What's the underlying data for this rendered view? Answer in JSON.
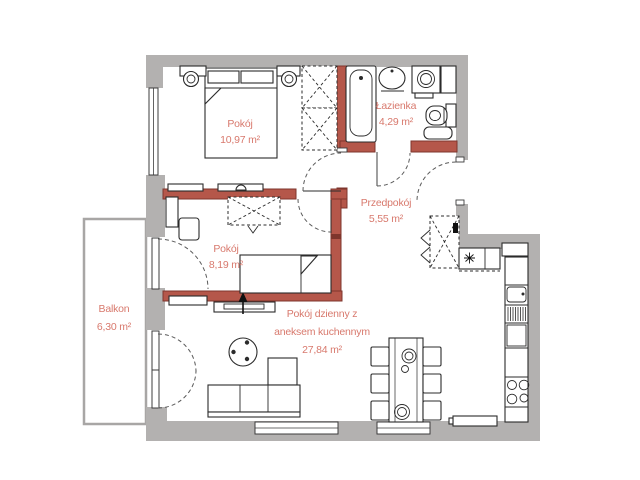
{
  "rooms": {
    "bedroom_1": {
      "name": "Pokój",
      "area": "10,97 m²"
    },
    "bathroom": {
      "name": "Łazienka",
      "area": "4,29 m²"
    },
    "hallway": {
      "name": "Przedpokój",
      "area": "5,55 m²"
    },
    "bedroom_2": {
      "name": "Pokój",
      "area": "8,19 m²"
    },
    "living_room": {
      "name_line_1": "Pokój dzienny z",
      "name_line_2": "aneksem kuchennym",
      "area": "27,84 m²"
    },
    "balcony": {
      "name": "Balkon",
      "area": "6,30 m²"
    }
  },
  "colors": {
    "wall_gray": "#b3b1b0",
    "wall_red": "#b5574a",
    "wall_red_dark": "#7e352c",
    "label": "#d8796d",
    "line": "#2b2b2b"
  }
}
